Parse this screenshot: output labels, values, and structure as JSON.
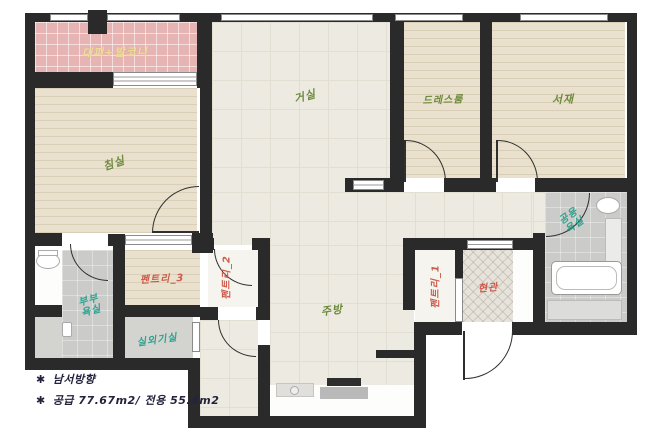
{
  "title": "apartment-floorplan",
  "rooms": {
    "balcony": {
      "label": "대피+발코니",
      "label_color": "#eedd9a"
    },
    "bedroom": {
      "label": "침실",
      "label_color": "#6e8b3d"
    },
    "living": {
      "label": "거실",
      "label_color": "#6e8b3d"
    },
    "dressroom": {
      "label": "드레스룸",
      "label_color": "#6e8b3d"
    },
    "study": {
      "label": "서재",
      "label_color": "#6e8b3d"
    },
    "pantry3": {
      "label": "펜트리_3",
      "label_color": "#cd5a4a"
    },
    "pantry2": {
      "label": "펜트리_2",
      "label_color": "#cd5a4a"
    },
    "pantry1": {
      "label": "펜트리_1",
      "label_color": "#cd5a4a"
    },
    "kitchen": {
      "label": "주방",
      "label_color": "#6e8b3d"
    },
    "entrance": {
      "label": "현관",
      "label_color": "#cd5a4a"
    },
    "master_bath": {
      "label": "부부욕실",
      "label_color": "#2ea390"
    },
    "utility": {
      "label": "실외기실",
      "label_color": "#2ea390"
    },
    "common_bath": {
      "label": "공용욕실",
      "label_color": "#2ea390"
    }
  },
  "notes": {
    "bullet": "✱",
    "direction": "남서방향",
    "area": "공급 77.67m2/ 전용 55.4m2"
  },
  "colors": {
    "wall": "#2a2a2a",
    "tile_floor": "#edebe1",
    "wood_floor": "#e9e1cd",
    "balcony_pink": "#e7b4b4",
    "bath_gray": "#cbcbc9",
    "entrance_tile": "#e6e3db",
    "green_label": "#6e8b3d",
    "red_label": "#cd5a4a",
    "teal_label": "#2ea390",
    "note_text": "#23233d"
  }
}
